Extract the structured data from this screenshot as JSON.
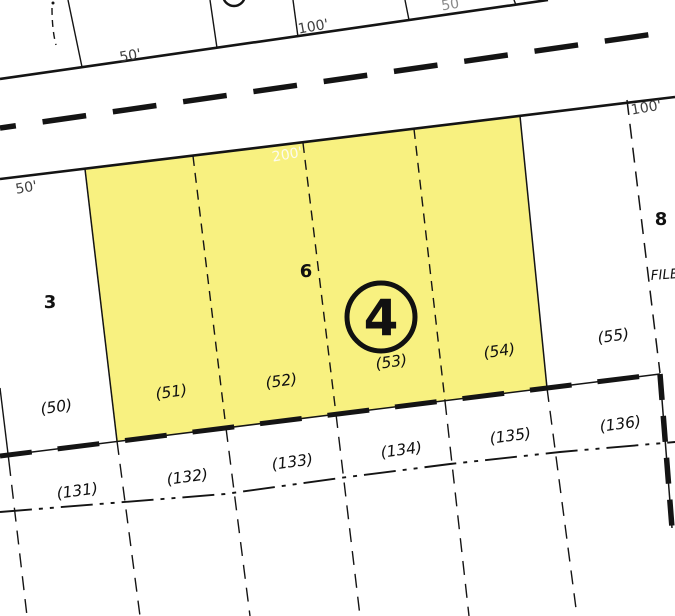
{
  "map": {
    "type": "cadastral-plat-map",
    "highlighted_lot_circle": "4",
    "colors": {
      "highlight_fill": "#F8F180",
      "line": "#141414",
      "dim_label": "#3f3f3f",
      "dim_label_light": "#8a8a8a",
      "dim_label_white": "#FCFBEF",
      "background": "#ffffff"
    },
    "dimensions": {
      "top_left": "50'",
      "top_center": "100'",
      "top_right": "50",
      "right": "100'",
      "frontage": "200'",
      "left": "50'"
    },
    "blocks": {
      "block_3": "3",
      "block_6": "6",
      "block_8": "8"
    },
    "annotations": {
      "file": "FILE"
    },
    "parcels_upper": {
      "p50": "(50)",
      "p51": "(51)",
      "p52": "(52)",
      "p53": "(53)",
      "p54": "(54)",
      "p55": "(55)"
    },
    "parcels_lower": {
      "p131": "(131)",
      "p132": "(132)",
      "p133": "(133)",
      "p134": "(134)",
      "p135": "(135)",
      "p136": "(136)"
    }
  }
}
